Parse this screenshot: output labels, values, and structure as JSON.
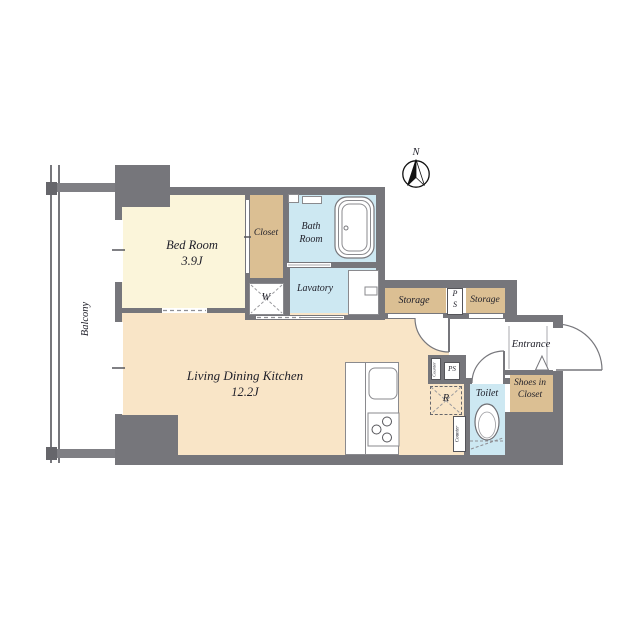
{
  "compass": {
    "north": "N"
  },
  "balcony": {
    "label": "Balcony"
  },
  "rooms": {
    "bedroom": {
      "name": "Bed Room",
      "size": "3.9J"
    },
    "ldk": {
      "name": "Living Dining Kitchen",
      "size": "12.2J"
    },
    "closet": {
      "label": "Closet"
    },
    "bathroom": {
      "line1": "Bath",
      "line2": "Room"
    },
    "lavatory": {
      "label": "Lavatory"
    },
    "storage_left": {
      "label": "Storage"
    },
    "storage_right": {
      "label": "Storage"
    },
    "pipe_shaft": {
      "line1": "P",
      "line2": "S"
    },
    "entrance": {
      "label": "Entrance"
    },
    "shoes_in_closet": {
      "line1": "Shoes in",
      "line2": "Closet"
    },
    "toilet": {
      "label": "Toilet"
    }
  },
  "fixtures": {
    "washing_machine": "W",
    "refrigerator": "R",
    "pipe_shaft_small": "PS",
    "kitchen_counter": "Counter",
    "toilet_counter": "Counter"
  },
  "colors": {
    "wall": "#76767b",
    "bedroom_floor": "#FBF5DA",
    "ldk_floor": "#F9E5C7",
    "storage_fill": "#DBBF93",
    "wet_area_fill": "#CDE8F2"
  }
}
